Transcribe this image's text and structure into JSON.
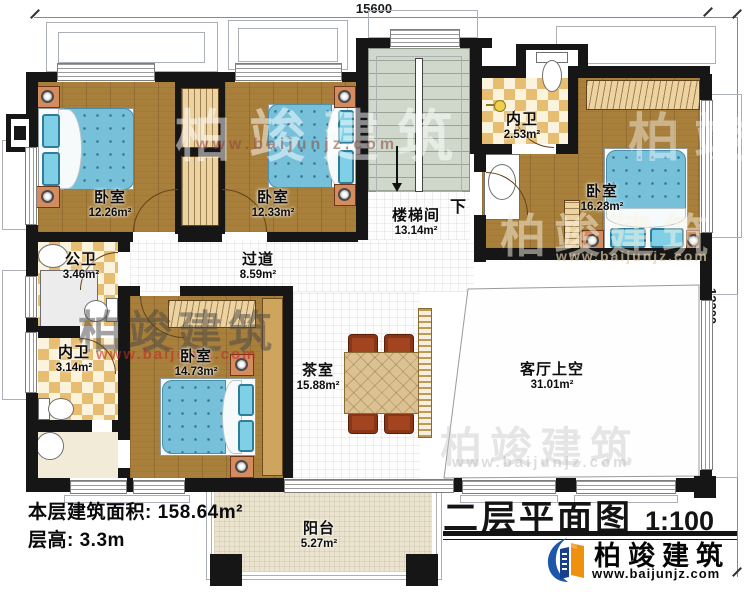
{
  "title_block": {
    "title": "二层平面图",
    "scale": "1:100"
  },
  "brand": {
    "name": "柏竣建筑",
    "url": "www.baijunjz.com"
  },
  "dimensions": {
    "top": "15600",
    "right": "12200"
  },
  "stats": {
    "floor_area": "本层建筑面积: 158.64m²",
    "floor_height": "层高: 3.3m"
  },
  "annotations": {
    "stairs_down": "下"
  },
  "rooms": [
    {
      "id": "bedroom-1",
      "label": "卧室",
      "area": "12.26m²"
    },
    {
      "id": "bedroom-2",
      "label": "卧室",
      "area": "12.33m²"
    },
    {
      "id": "ensuite-bath-1",
      "label": "内卫",
      "area": "2.53m²"
    },
    {
      "id": "bedroom-3",
      "label": "卧室",
      "area": "16.28m²"
    },
    {
      "id": "stairwell",
      "label": "楼梯间",
      "area": "13.14m²"
    },
    {
      "id": "corridor",
      "label": "过道",
      "area": "8.59m²"
    },
    {
      "id": "public-bath",
      "label": "公卫",
      "area": "3.46m²"
    },
    {
      "id": "ensuite-bath-2",
      "label": "内卫",
      "area": "3.14m²"
    },
    {
      "id": "bedroom-4",
      "label": "卧室",
      "area": "14.73m²"
    },
    {
      "id": "tea-room",
      "label": "茶室",
      "area": "15.88m²"
    },
    {
      "id": "living-void",
      "label": "客厅上空",
      "area": "31.01m²"
    },
    {
      "id": "balcony",
      "label": "阳台",
      "area": "5.27m²"
    }
  ],
  "colors": {
    "wall": "#161616",
    "wood_floor": "#a8803c",
    "bath_tile": "#e7bd72",
    "bed_blue": "#76c0da",
    "stair_floor": "#cfd8ca",
    "balcony_floor": "#ebe3cd",
    "brand_blue": "#1c57a8",
    "brand_orange": "#f0900f",
    "watermark_red": "#c0392b"
  }
}
